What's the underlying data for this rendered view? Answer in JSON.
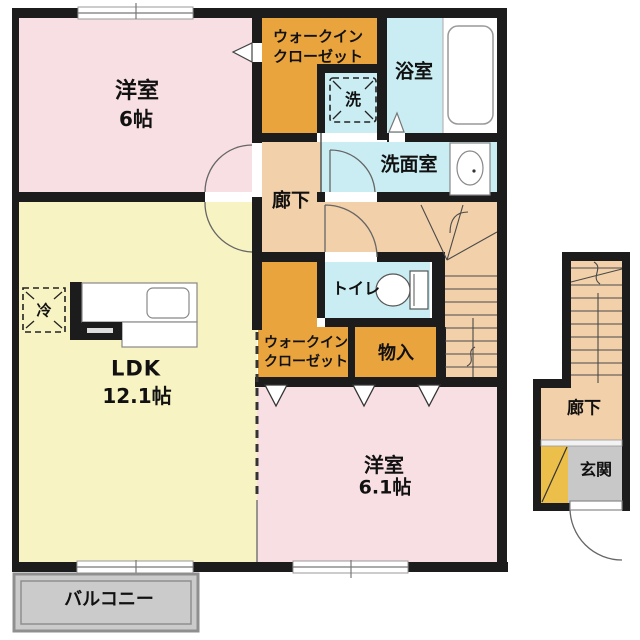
{
  "floor_plan": {
    "rooms": {
      "bedroom1": {
        "name": "洋室",
        "size": "6帖"
      },
      "walk_in_closet_1": {
        "line1": "ウォークイン",
        "line2": "クローゼット"
      },
      "bathroom": {
        "name": "浴室"
      },
      "washer_space": {
        "name": "洗"
      },
      "washroom": {
        "name": "洗面室"
      },
      "hallway": {
        "name": "廊下"
      },
      "toilet": {
        "name": "トイレ"
      },
      "ldk": {
        "name": "LDK",
        "size": "12.1帖"
      },
      "refrigerator_space": {
        "name": "冷"
      },
      "walk_in_closet_2": {
        "line1": "ウォークイン",
        "line2": "クローゼット"
      },
      "storage": {
        "name": "物入"
      },
      "bedroom2": {
        "name": "洋室",
        "size": "6.1帖"
      },
      "balcony": {
        "name": "バルコニー"
      }
    },
    "entrance_section": {
      "hallway": {
        "name": "廊下"
      },
      "entrance": {
        "name": "玄関"
      }
    },
    "colors": {
      "room_pink": "#f8dfe4",
      "room_yellow": "#f7f3c2",
      "room_orange": "#e9a43e",
      "room_tan": "#f2d0a9",
      "room_blue": "#c9edf2",
      "entrance_gray": "#c8c8c8",
      "balcony_gray": "#cbcbcb",
      "shoe_cabinet_yellow": "#ecbf4a",
      "wall_black": "#1c1c1c"
    }
  }
}
